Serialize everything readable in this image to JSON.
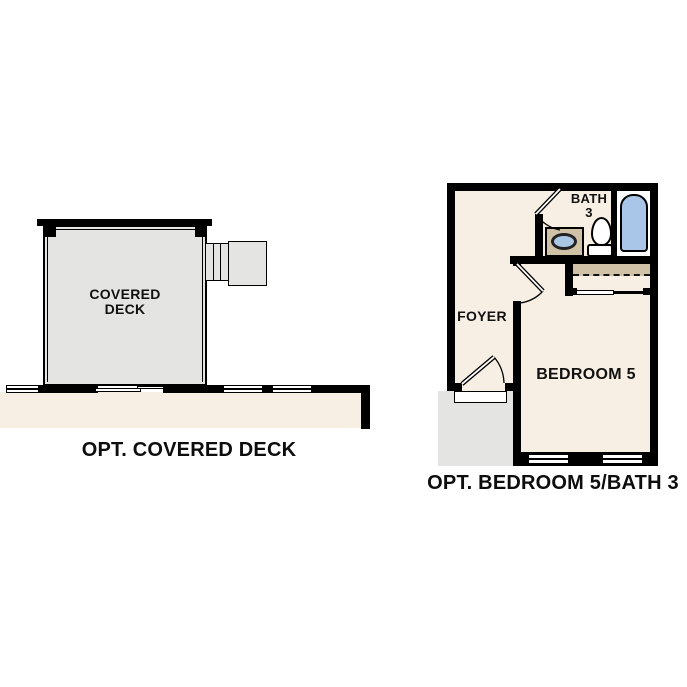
{
  "left_plan": {
    "room_label_line1": "COVERED",
    "room_label_line2": "DECK",
    "caption": "OPT. COVERED DECK"
  },
  "right_plan": {
    "bath_label_line1": "BATH",
    "bath_label_line2": "3",
    "foyer_label": "FOYER",
    "bedroom_label": "BEDROOM 5",
    "caption": "OPT. BEDROOM 5/BATH 3"
  },
  "colors": {
    "background": "#ffffff",
    "wall_black": "#000000",
    "interior_cream": "#f7efe3",
    "deck_gray": "#e4e4e2",
    "closet_tan": "#d0c2a6",
    "tub_blue": "#a9c6e8",
    "sink_blue": "#aac8e4"
  }
}
